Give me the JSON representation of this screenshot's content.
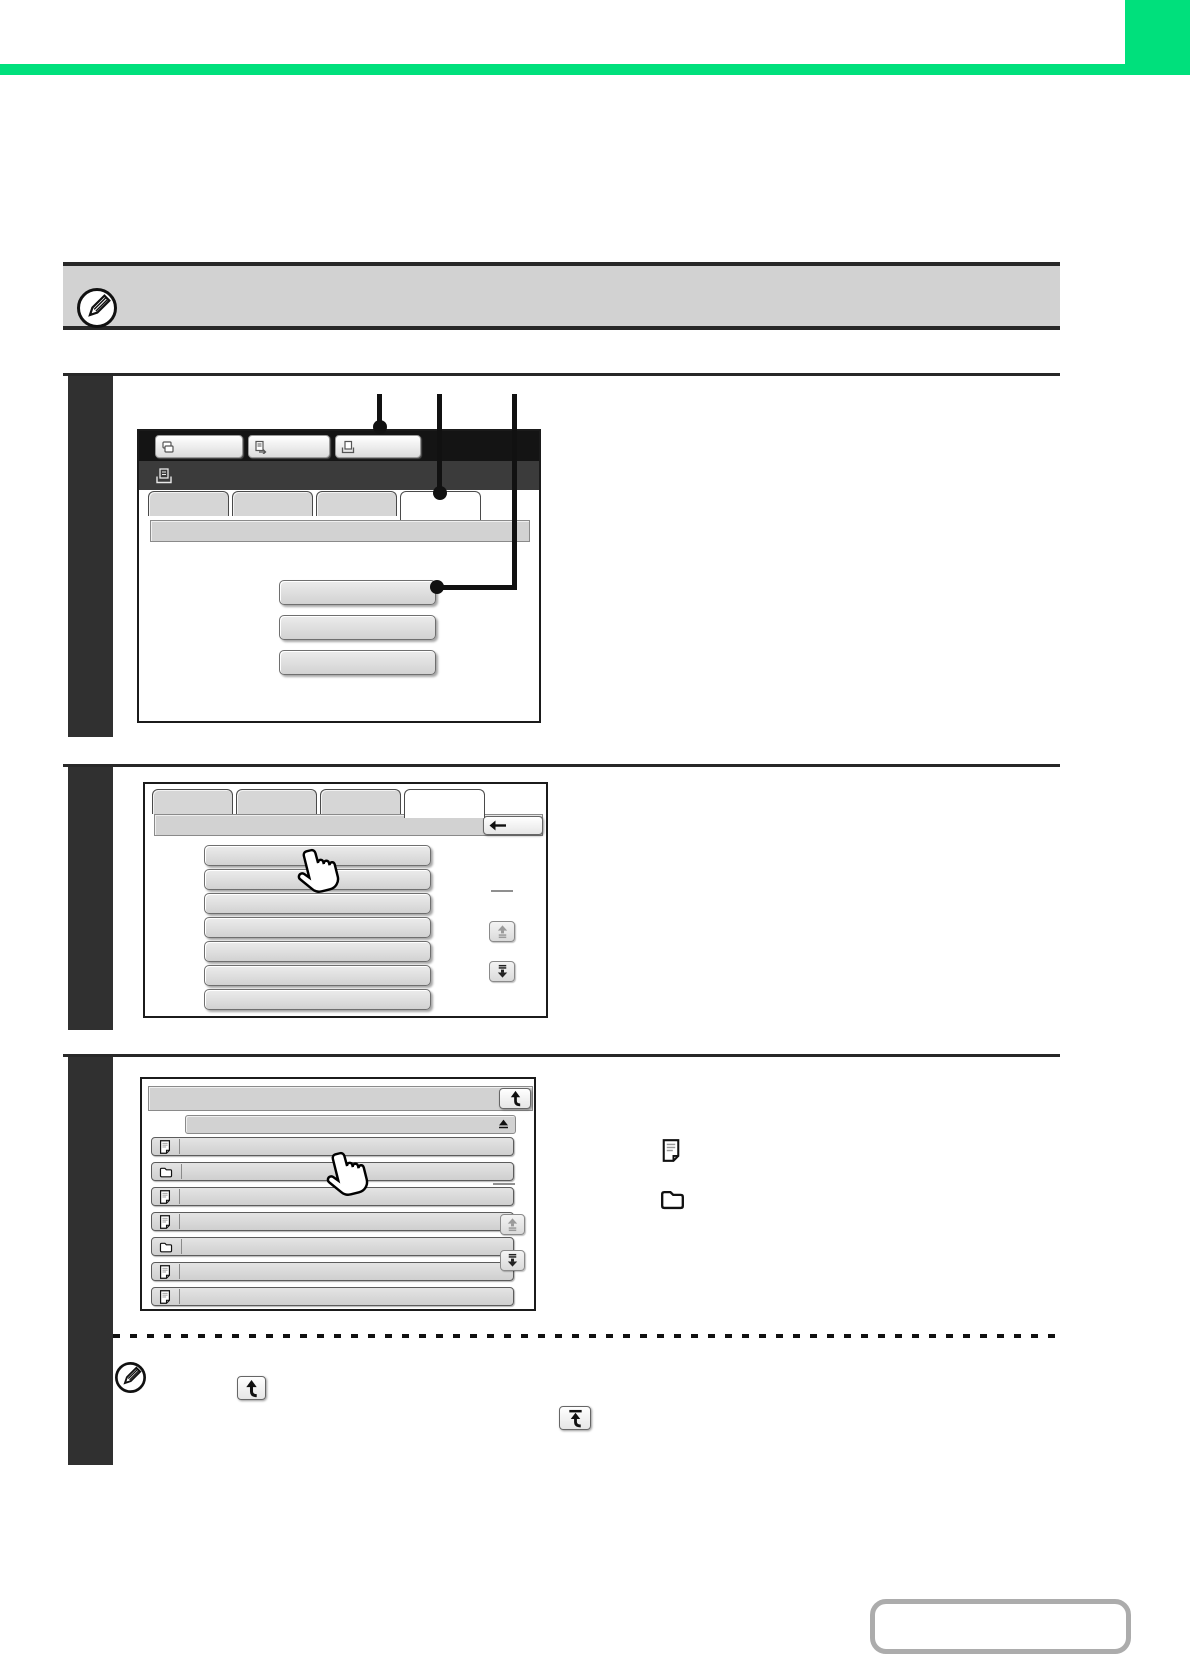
{
  "theme": {
    "accent_green": "#00E07C",
    "step_bar_color": "#303030",
    "screen_topbar_color": "#141414",
    "screen_titlebar_color": "#3B3B3B",
    "button_gray": "#D8D8D8",
    "note_bg": "#D2D2D2",
    "callout_color": "#111111"
  },
  "note_top": {
    "icon": "pencil-note-icon",
    "text": ""
  },
  "steps": {
    "step1": {
      "screen": {
        "toolbar_buttons": [
          {
            "icon": "copy-mode-icon",
            "label": ""
          },
          {
            "icon": "image-send-mode-icon",
            "label": ""
          },
          {
            "icon": "doc-filing-mode-icon",
            "label": ""
          }
        ],
        "titlebar": {
          "icon": "doc-filing-icon",
          "label": ""
        },
        "tabs": [
          {
            "label": "",
            "selected": false
          },
          {
            "label": "",
            "selected": false
          },
          {
            "label": "",
            "selected": false
          },
          {
            "label": "",
            "selected": true
          }
        ],
        "subheader": {
          "label": ""
        },
        "menu_buttons": [
          {
            "label": ""
          },
          {
            "label": ""
          },
          {
            "label": ""
          }
        ]
      },
      "callouts": [
        "toolbar-button-3",
        "tab-4",
        "menu-button-1"
      ]
    },
    "step2": {
      "screen": {
        "tabs": [
          {
            "label": "",
            "selected": false
          },
          {
            "label": "",
            "selected": false
          },
          {
            "label": "",
            "selected": false
          },
          {
            "label": "",
            "selected": true
          }
        ],
        "header": {
          "label": "",
          "back_icon": "back-arrow-icon"
        },
        "list_buttons": [
          {
            "label": ""
          },
          {
            "label": ""
          },
          {
            "label": ""
          },
          {
            "label": ""
          },
          {
            "label": ""
          },
          {
            "label": ""
          },
          {
            "label": ""
          }
        ],
        "pager": {
          "separator": "",
          "up_icon": "scroll-up-icon",
          "down_icon": "scroll-down-icon"
        },
        "cursor": "hand-pointer"
      }
    },
    "step3": {
      "screen": {
        "header": {
          "label": "",
          "return_icon": "folder-up-icon"
        },
        "sort_bar": {
          "label": "",
          "icon": "sort-asc-icon"
        },
        "rows": [
          {
            "type": "file",
            "label": ""
          },
          {
            "type": "folder",
            "label": ""
          },
          {
            "type": "file",
            "label": ""
          },
          {
            "type": "file",
            "label": ""
          },
          {
            "type": "folder",
            "label": ""
          },
          {
            "type": "file",
            "label": ""
          },
          {
            "type": "file",
            "label": ""
          }
        ],
        "pager": {
          "separator": "",
          "up_icon": "scroll-up-icon",
          "down_icon": "scroll-down-icon"
        },
        "cursor": "hand-pointer"
      },
      "legend": [
        {
          "icon": "file-icon",
          "text": ""
        },
        {
          "icon": "folder-icon",
          "text": ""
        }
      ],
      "note": {
        "icon": "pencil-note-icon",
        "inline_icons": [
          "folder-up-icon",
          "folder-up-root-icon"
        ],
        "text": ""
      }
    }
  },
  "footer": {
    "nav_box_label": ""
  }
}
